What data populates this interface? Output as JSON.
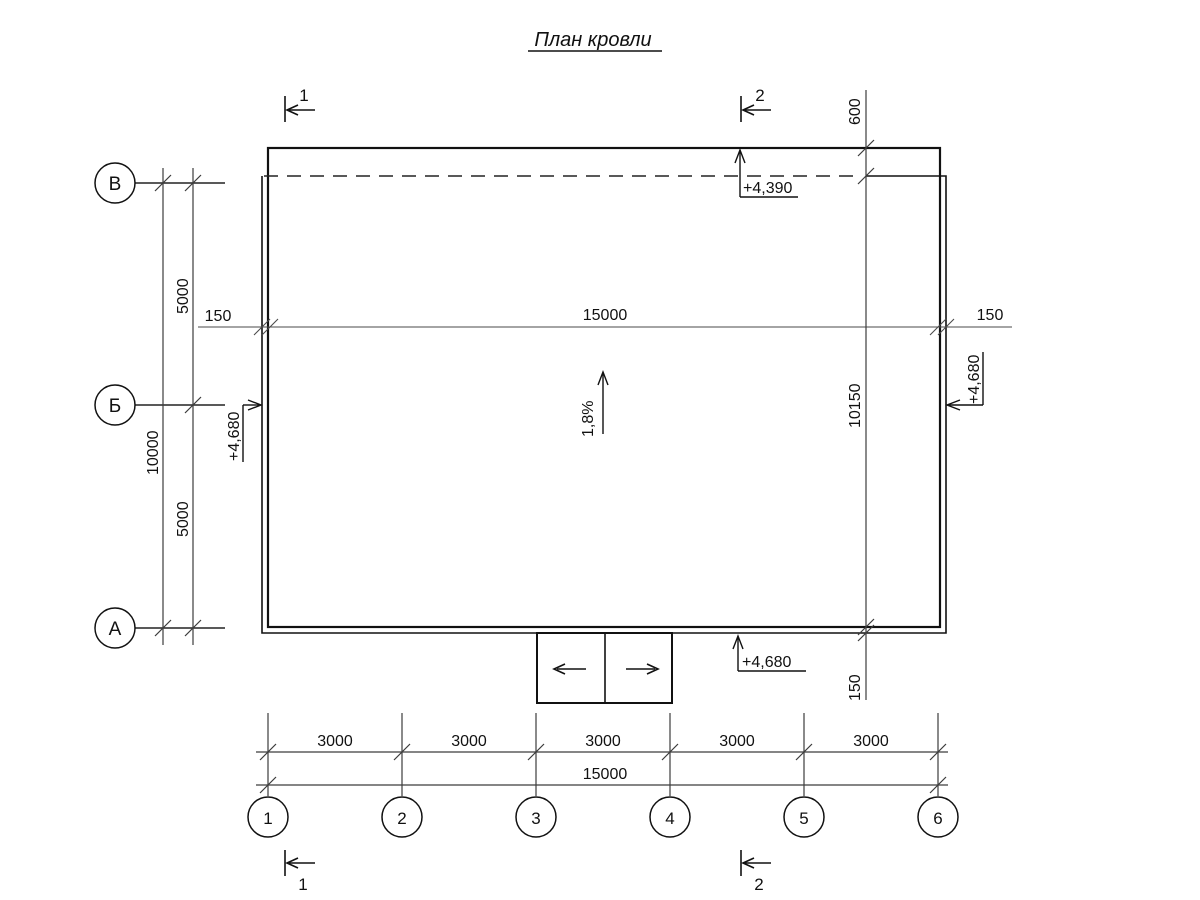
{
  "title": "План кровли",
  "colors": {
    "outline": "#111111",
    "dim_line": "#3c3c3c",
    "background": "#ffffff"
  },
  "axes": {
    "vertical": [
      "В",
      "Б",
      "А"
    ],
    "horizontal": [
      "1",
      "2",
      "3",
      "4",
      "5",
      "6"
    ]
  },
  "dims": {
    "left_span_top": "5000",
    "left_span_bottom": "5000",
    "left_total": "10000",
    "overhang_left": "150",
    "width_total": "15000",
    "overhang_right": "150",
    "right_top": "600",
    "right_total": "10150",
    "right_bottom": "150",
    "bottom_spans": [
      "3000",
      "3000",
      "3000",
      "3000",
      "3000"
    ],
    "bottom_total": "15000"
  },
  "elevations": {
    "top": "+4,390",
    "left": "+4,680",
    "right": "+4,680",
    "bottom_canopy": "+4,680"
  },
  "slope": "1,8%",
  "sections": {
    "mark1": "1",
    "mark2": "2"
  }
}
